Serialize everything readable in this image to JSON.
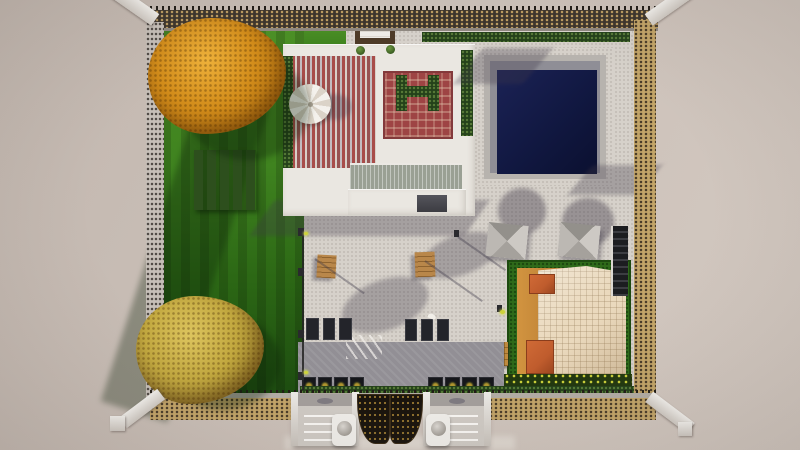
{
  "meta": {
    "type": "top-down 3d architectural render",
    "subject": "walled residential compound with garden, rooftop terrace, swimming pool, courtyard and hip-roof house",
    "visible_text": "none"
  },
  "palette": {
    "bg-dark": "#c2b7af",
    "bg-mid": "#cbc0b8",
    "bg-light": "#d3c9c1",
    "paving": "#d6d1ca",
    "paving-dark": "#928f95",
    "lawn-bright": "#4c9026",
    "lawn-dark": "#1d4c10",
    "tree-orange": "#d28c1a",
    "tree-orange-light": "#eeb13a",
    "tree-yellow": "#c2a83f",
    "tree-yellow-light": "#dcc45e",
    "vine": "#2d4f1d",
    "hedge": "#24411a",
    "roof-white": "#eae7e1",
    "stripe-red": "#a84c49",
    "stripe-cream": "#d9cfc8",
    "carpet-red": "#9e4444",
    "louver": "#9aa094",
    "canopy-frame": "#4e3b28",
    "pool-water": "#10173f",
    "house-roof": "#ead9bd",
    "house-wall": "#d29440",
    "dormer": "#bf5c2d",
    "wall-dark": "#3d352c",
    "wall-tan": "#c2a468",
    "wall-gray": "#c6bfb8",
    "gate-dark": "#1a140d",
    "pillar-white": "#eceae6",
    "wood": "#b9874a",
    "mat-dark": "#23242a",
    "sign-yellow": "#cdd23a"
  },
  "objects": {
    "vegetation": [
      "autumn-tree-northwest",
      "autumn-tree-southwest",
      "vine-trellis",
      "hedge-strips",
      "flower-hedge"
    ],
    "water": [
      "swimming-pool"
    ],
    "structures": [
      "rooftop-terrace",
      "striped-patio",
      "red-carpet-pergola",
      "louvered-roof",
      "entrance-canopy",
      "hip-roof-house",
      "perimeter-wall",
      "corner-pillars"
    ],
    "courtyard-items": [
      "patio-umbrella",
      "shade-canopies",
      "wood-tables",
      "street-lamps",
      "floor-mats",
      "crosswalk-marks",
      "sign-panels",
      "blue-bench",
      "planter-crate"
    ],
    "entrance": [
      "left-stairs",
      "right-stairs",
      "ornate-gate",
      "dome-pillar-left",
      "dome-pillar-right"
    ]
  }
}
